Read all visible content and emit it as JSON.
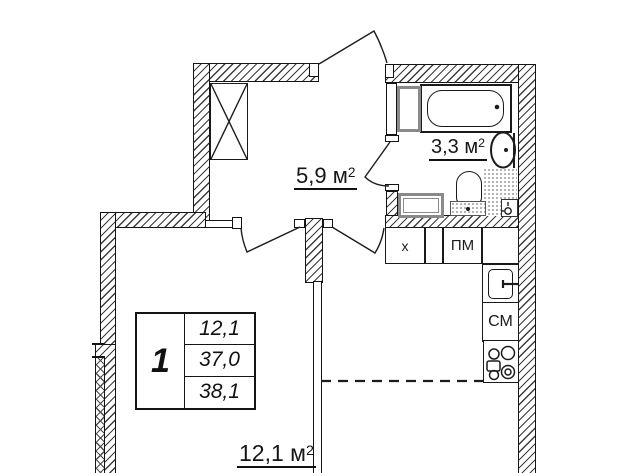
{
  "labels": {
    "hallway": {
      "text": "5,9 м",
      "sup": "2"
    },
    "bathroom": {
      "text": "3,3 м",
      "sup": "2"
    },
    "room": {
      "text": "12,1 м",
      "sup": "2"
    }
  },
  "legend": {
    "room_count": "1",
    "rows": [
      "12,1",
      "37,0",
      "38,1"
    ]
  },
  "appliances": {
    "fridge": "х",
    "dishwasher": "ПМ",
    "washing_machine": "СМ"
  },
  "icons": {
    "wardrobe": "crossed-box",
    "bathtub": "tub-outline",
    "washbasin": "oval-basin",
    "toilet": "toilet-outline",
    "bath_washer": "front-load-washer",
    "floor_drain": "drain-box",
    "kitchen_sink": "sink-with-faucet",
    "stove": "four-burner-stove",
    "doors": "quarter-circle-swing"
  },
  "colors": {
    "wall_line": "#141414",
    "hatch_line": "#3c3c3c",
    "appliance_gray": "#8a8a8a",
    "text": "#111111",
    "background": "#ffffff"
  }
}
